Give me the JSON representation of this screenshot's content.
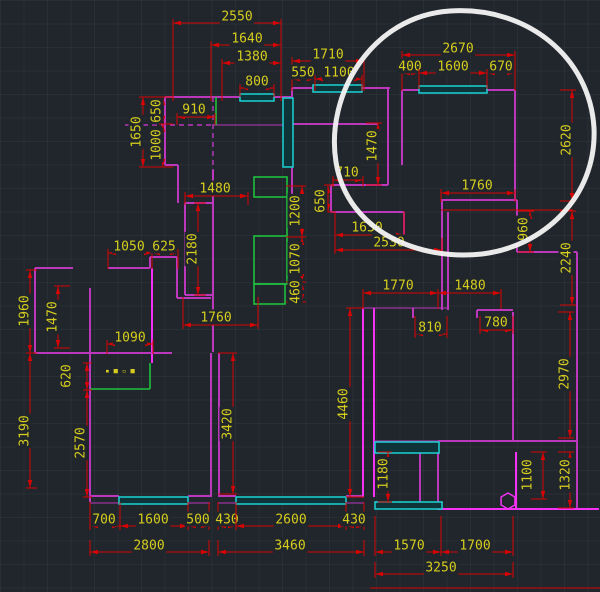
{
  "canvas": {
    "width": 600,
    "height": 592,
    "description": "CAD floor plan drawing with dimension annotations and hand-drawn circle highlight"
  },
  "colors": {
    "background": "#20262b",
    "dimension_red": "#d60404",
    "text_yellow": "#d6cd1e",
    "wall_magenta": "#bb37bb",
    "wall_bright_magenta": "#f531f5",
    "window_cyan": "#1bd3d3",
    "window_fill": "#0e3339",
    "furniture_green": "#1fbf3f",
    "annotation_white": "#f2f2f2"
  },
  "drawing": {
    "dimensions": [
      {
        "t": "2550",
        "o": "h",
        "x": 237,
        "y": 16,
        "p": 23,
        "a": 173,
        "b": 281,
        "ed": "down",
        "el": 78
      },
      {
        "t": "1640",
        "o": "h",
        "x": 247,
        "y": 38,
        "p": 45,
        "a": 211,
        "b": 281,
        "ed": "down",
        "el": 56
      },
      {
        "t": "1380",
        "o": "h",
        "x": 252,
        "y": 56,
        "p": 63,
        "a": 222,
        "b": 281,
        "ed": "down",
        "el": 38
      },
      {
        "t": "800",
        "o": "h",
        "x": 257,
        "y": 81,
        "p": 88,
        "a": 240,
        "b": 274,
        "ed": "down",
        "el": 9
      },
      {
        "t": "1710",
        "o": "h",
        "x": 328,
        "y": 54,
        "p": 61,
        "a": 292,
        "b": 364,
        "ed": "down",
        "el": 30
      },
      {
        "t": "550",
        "o": "h",
        "x": 303,
        "y": 72,
        "p": 79,
        "a": 292,
        "b": 315,
        "ed": "down",
        "el": 12
      },
      {
        "t": "1100",
        "o": "h",
        "x": 339,
        "y": 72,
        "p": 79,
        "a": 315,
        "b": 362,
        "ed": "down",
        "el": 12
      },
      {
        "t": "2670",
        "o": "h",
        "x": 458,
        "y": 48,
        "p": 55,
        "a": 402,
        "b": 515,
        "ed": "down",
        "el": 36
      },
      {
        "t": "400",
        "o": "h",
        "x": 410,
        "y": 66,
        "p": 73,
        "a": 402,
        "b": 419,
        "ed": "down",
        "el": 16
      },
      {
        "t": "1600",
        "o": "h",
        "x": 453,
        "y": 66,
        "p": 73,
        "a": 419,
        "b": 487,
        "ed": "down",
        "el": 16
      },
      {
        "t": "670",
        "o": "h",
        "x": 501,
        "y": 66,
        "p": 73,
        "a": 487,
        "b": 515,
        "ed": "down",
        "el": 16
      },
      {
        "t": "1650",
        "o": "v",
        "x": 136,
        "y": 132,
        "p": 143,
        "a": 97,
        "b": 167,
        "ed": "right",
        "el": 24
      },
      {
        "t": "650",
        "o": "v",
        "x": 156,
        "y": 111,
        "p": 163,
        "a": 97,
        "b": 124,
        "ed": "right",
        "el": 10
      },
      {
        "t": "1000",
        "o": "v",
        "x": 156,
        "y": 145,
        "p": 163,
        "a": 124,
        "b": 167,
        "ed": "right",
        "el": 10
      },
      {
        "t": "910",
        "o": "h",
        "x": 194,
        "y": 109,
        "p": 117,
        "a": 177,
        "b": 215,
        "ed": "down",
        "el": 8
      },
      {
        "t": "1480",
        "o": "h",
        "x": 215,
        "y": 188,
        "p": 196,
        "a": 185,
        "b": 248,
        "ed": "down",
        "el": 9
      },
      {
        "t": "2180",
        "o": "v",
        "x": 192,
        "y": 249,
        "p": 198,
        "a": 203,
        "b": 295,
        "ed": "right",
        "el": 8
      },
      {
        "t": "1760",
        "o": "h",
        "x": 216,
        "y": 317,
        "p": 325,
        "a": 183,
        "b": 258,
        "ed": "up",
        "el": 28
      },
      {
        "t": "1200",
        "o": "v",
        "x": 295,
        "y": 211,
        "p": 302,
        "a": 186,
        "b": 237,
        "ed": "left",
        "el": 16
      },
      {
        "t": "1070",
        "o": "v",
        "x": 295,
        "y": 259,
        "p": 302,
        "a": 237,
        "b": 282,
        "ed": "left",
        "el": 16
      },
      {
        "t": "460",
        "o": "v",
        "x": 295,
        "y": 292,
        "p": 302,
        "a": 282,
        "b": 302,
        "ed": "left",
        "el": 16
      },
      {
        "t": "1050",
        "o": "h",
        "x": 129,
        "y": 246,
        "p": 253,
        "a": 108,
        "b": 152,
        "ed": "down",
        "el": 16
      },
      {
        "t": "625",
        "o": "h",
        "x": 164,
        "y": 246,
        "p": 253,
        "a": 152,
        "b": 178,
        "ed": "down",
        "el": 16
      },
      {
        "t": "1090",
        "o": "h",
        "x": 130,
        "y": 337,
        "p": 344,
        "a": 107,
        "b": 153,
        "ed": "down",
        "el": 10
      },
      {
        "t": "1960",
        "o": "v",
        "x": 24,
        "y": 311,
        "p": 30,
        "a": 270,
        "b": 353,
        "ed": "right",
        "el": 7
      },
      {
        "t": "1470",
        "o": "v",
        "x": 52,
        "y": 317,
        "p": 58,
        "a": 286,
        "b": 348,
        "ed": "right",
        "el": 12
      },
      {
        "t": "620",
        "o": "v",
        "x": 66,
        "y": 376,
        "p": 87,
        "a": 363,
        "b": 390,
        "ed": "right",
        "el": 5
      },
      {
        "t": "2570",
        "o": "v",
        "x": 80,
        "y": 443,
        "p": 87,
        "a": 390,
        "b": 497,
        "ed": "right",
        "el": 5
      },
      {
        "t": "3190",
        "o": "v",
        "x": 24,
        "y": 431,
        "p": 30,
        "a": 353,
        "b": 488,
        "ed": "right",
        "el": 7
      },
      {
        "t": "1470",
        "o": "v",
        "x": 372,
        "y": 146,
        "p": 378,
        "a": 123,
        "b": 185,
        "ed": "left",
        "el": 12
      },
      {
        "t": "710",
        "o": "h",
        "x": 347,
        "y": 172,
        "p": 180,
        "a": 333,
        "b": 363,
        "ed": "down",
        "el": 7
      },
      {
        "t": "650",
        "o": "v",
        "x": 320,
        "y": 201,
        "p": 328,
        "a": 185,
        "b": 212,
        "ed": "right",
        "el": 6
      },
      {
        "t": "1630",
        "o": "h",
        "x": 367,
        "y": 227,
        "p": 235,
        "a": 335,
        "b": 404,
        "ed": "up",
        "el": 24
      },
      {
        "t": "2530",
        "o": "h",
        "x": 389,
        "y": 242,
        "p": 250,
        "a": 335,
        "b": 442,
        "ed": "up",
        "el": 12
      },
      {
        "t": "1760",
        "o": "h",
        "x": 477,
        "y": 185,
        "p": 193,
        "a": 441,
        "b": 515,
        "ed": "down",
        "el": 9
      },
      {
        "t": "2620",
        "o": "v",
        "x": 566,
        "y": 140,
        "p": 572,
        "a": 90,
        "b": 201,
        "ed": "left",
        "el": 12
      },
      {
        "t": "960",
        "o": "v",
        "x": 523,
        "y": 229,
        "p": 530,
        "a": 211,
        "b": 252,
        "ed": "left",
        "el": 12
      },
      {
        "t": "2240",
        "o": "v",
        "x": 566,
        "y": 258,
        "p": 572,
        "a": 211,
        "b": 305,
        "ed": "left",
        "el": 12
      },
      {
        "t": "1770",
        "o": "h",
        "x": 398,
        "y": 285,
        "p": 293,
        "a": 363,
        "b": 438,
        "ed": "down",
        "el": 16
      },
      {
        "t": "1480",
        "o": "h",
        "x": 470,
        "y": 285,
        "p": 293,
        "a": 438,
        "b": 501,
        "ed": "down",
        "el": 16
      },
      {
        "t": "810",
        "o": "h",
        "x": 430,
        "y": 327,
        "p": 334,
        "a": 415,
        "b": 447,
        "ed": "up",
        "el": 18
      },
      {
        "t": "780",
        "o": "h",
        "x": 496,
        "y": 322,
        "p": 330,
        "a": 480,
        "b": 513,
        "ed": "up",
        "el": 14
      },
      {
        "t": "2970",
        "o": "v",
        "x": 564,
        "y": 374,
        "p": 570,
        "a": 312,
        "b": 438,
        "ed": "left",
        "el": 12
      },
      {
        "t": "4460",
        "o": "v",
        "x": 343,
        "y": 404,
        "p": 350,
        "a": 308,
        "b": 497,
        "ed": "right",
        "el": 14
      },
      {
        "t": "3420",
        "o": "v",
        "x": 227,
        "y": 424,
        "p": 233,
        "a": 353,
        "b": 494,
        "ed": "left",
        "el": 15
      },
      {
        "t": "1180",
        "o": "v",
        "x": 383,
        "y": 474,
        "p": 388,
        "a": 452,
        "b": 502,
        "ed": "left",
        "el": 10
      },
      {
        "t": "1100",
        "o": "v",
        "x": 527,
        "y": 475,
        "p": 543,
        "a": 452,
        "b": 499,
        "ed": "left",
        "el": 12
      },
      {
        "t": "1320",
        "o": "v",
        "x": 565,
        "y": 475,
        "p": 570,
        "a": 452,
        "b": 508,
        "ed": "left",
        "el": 12
      },
      {
        "t": "1570",
        "o": "h",
        "x": 409,
        "y": 545,
        "p": 552,
        "a": 375,
        "b": 441,
        "ed": "up",
        "el": 36
      },
      {
        "t": "1700",
        "o": "h",
        "x": 475,
        "y": 545,
        "p": 552,
        "a": 441,
        "b": 513,
        "ed": "up",
        "el": 36
      },
      {
        "t": "3250",
        "o": "h",
        "x": 441,
        "y": 567,
        "p": 574,
        "a": 375,
        "b": 513,
        "ed": "up",
        "el": 12
      },
      {
        "t": "700",
        "o": "h",
        "x": 104,
        "y": 519,
        "p": 526,
        "a": 90,
        "b": 120,
        "ed": "up",
        "el": 24
      },
      {
        "t": "1600",
        "o": "h",
        "x": 153,
        "y": 519,
        "p": 526,
        "a": 120,
        "b": 188,
        "ed": "up",
        "el": 24
      },
      {
        "t": "500",
        "o": "h",
        "x": 198,
        "y": 519,
        "p": 526,
        "a": 188,
        "b": 209,
        "ed": "up",
        "el": 24
      },
      {
        "t": "2800",
        "o": "h",
        "x": 149,
        "y": 545,
        "p": 552,
        "a": 90,
        "b": 209,
        "ed": "up",
        "el": 12
      },
      {
        "t": "430",
        "o": "h",
        "x": 227,
        "y": 519,
        "p": 526,
        "a": 218,
        "b": 236,
        "ed": "up",
        "el": 24
      },
      {
        "t": "2600",
        "o": "h",
        "x": 291,
        "y": 519,
        "p": 526,
        "a": 236,
        "b": 346,
        "ed": "up",
        "el": 24
      },
      {
        "t": "430",
        "o": "h",
        "x": 354,
        "y": 519,
        "p": 526,
        "a": 346,
        "b": 364,
        "ed": "up",
        "el": 24
      },
      {
        "t": "3460",
        "o": "h",
        "x": 290,
        "y": 545,
        "p": 552,
        "a": 218,
        "b": 364,
        "ed": "up",
        "el": 12
      }
    ],
    "walls": [
      [
        165,
        97,
        292,
        97,
        "w"
      ],
      [
        165,
        97,
        165,
        165,
        "w"
      ],
      [
        165,
        165,
        178,
        165,
        "w"
      ],
      [
        178,
        165,
        178,
        203,
        "w"
      ],
      [
        125,
        125,
        213,
        125,
        "d"
      ],
      [
        213,
        125,
        290,
        125,
        "t"
      ],
      [
        292,
        88,
        292,
        212,
        "w"
      ],
      [
        292,
        88,
        390,
        88,
        "w"
      ],
      [
        388,
        88,
        388,
        185,
        "w"
      ],
      [
        292,
        124,
        378,
        124,
        "w"
      ],
      [
        331,
        185,
        388,
        185,
        "w"
      ],
      [
        331,
        185,
        331,
        212,
        "w"
      ],
      [
        331,
        212,
        404,
        212,
        "w"
      ],
      [
        404,
        212,
        404,
        250,
        "w"
      ],
      [
        402,
        90,
        515,
        90,
        "w"
      ],
      [
        402,
        90,
        402,
        165,
        "w"
      ],
      [
        515,
        90,
        515,
        200,
        "w"
      ],
      [
        441,
        200,
        517,
        200,
        "w"
      ],
      [
        442,
        200,
        442,
        310,
        "w"
      ],
      [
        448,
        212,
        448,
        310,
        "w"
      ],
      [
        517,
        200,
        517,
        252,
        "w"
      ],
      [
        517,
        252,
        577,
        252,
        "w"
      ],
      [
        577,
        252,
        577,
        509,
        "w"
      ],
      [
        441,
        210,
        573,
        210,
        "r"
      ],
      [
        370,
        588,
        600,
        588,
        "r"
      ],
      [
        185,
        203,
        213,
        203,
        "w"
      ],
      [
        185,
        203,
        185,
        295,
        "w"
      ],
      [
        185,
        295,
        213,
        295,
        "w"
      ],
      [
        213,
        97,
        213,
        170,
        "d"
      ],
      [
        213,
        170,
        213,
        352,
        "w"
      ],
      [
        211,
        353,
        211,
        497,
        "w"
      ],
      [
        219,
        353,
        219,
        497,
        "w"
      ],
      [
        35,
        268,
        73,
        268,
        "w"
      ],
      [
        108,
        268,
        150,
        268,
        "w"
      ],
      [
        150,
        257,
        150,
        268,
        "w"
      ],
      [
        150,
        257,
        177,
        257,
        "w"
      ],
      [
        177,
        257,
        177,
        298,
        "w"
      ],
      [
        177,
        298,
        211,
        298,
        "w"
      ],
      [
        35,
        268,
        35,
        353,
        "w"
      ],
      [
        90,
        288,
        90,
        353,
        "w"
      ],
      [
        35,
        353,
        90,
        353,
        "w"
      ],
      [
        152,
        268,
        152,
        363,
        "b"
      ],
      [
        90,
        353,
        172,
        353,
        "w"
      ],
      [
        90,
        353,
        90,
        502,
        "w"
      ],
      [
        90,
        496,
        119,
        496,
        "w"
      ],
      [
        188,
        496,
        210,
        496,
        "w"
      ],
      [
        90,
        503,
        210,
        503,
        "t"
      ],
      [
        218,
        496,
        236,
        496,
        "w"
      ],
      [
        346,
        496,
        364,
        496,
        "w"
      ],
      [
        218,
        503,
        364,
        503,
        "t"
      ],
      [
        363,
        308,
        363,
        497,
        "b"
      ],
      [
        374,
        308,
        374,
        497,
        "b"
      ],
      [
        363,
        308,
        447,
        308,
        "t"
      ],
      [
        413,
        308,
        413,
        318,
        "w"
      ],
      [
        477,
        310,
        513,
        310,
        "w"
      ],
      [
        477,
        310,
        477,
        318,
        "w"
      ],
      [
        513,
        312,
        513,
        441,
        "w"
      ],
      [
        438,
        441,
        577,
        441,
        "w"
      ],
      [
        438,
        441,
        438,
        509,
        "w"
      ],
      [
        374,
        441,
        440,
        441,
        "t"
      ],
      [
        374,
        453,
        440,
        453,
        "t"
      ],
      [
        420,
        453,
        420,
        502,
        "w"
      ],
      [
        374,
        502,
        443,
        502,
        "t"
      ],
      [
        437,
        509,
        599,
        509,
        "b"
      ],
      [
        516,
        452,
        516,
        509,
        "b"
      ]
    ],
    "windows": [
      [
        240,
        94,
        34,
        7
      ],
      [
        283,
        98,
        10,
        69
      ],
      [
        313,
        85,
        49,
        7
      ],
      [
        419,
        86,
        68,
        7
      ],
      [
        375,
        442,
        64,
        11
      ],
      [
        375,
        502,
        67,
        7
      ],
      [
        119,
        497,
        69,
        7
      ],
      [
        236,
        497,
        110,
        7
      ]
    ],
    "furniture_rects": [
      [
        254,
        177,
        33,
        20
      ],
      [
        254,
        236,
        33,
        48
      ],
      [
        254,
        284,
        31,
        20
      ]
    ],
    "furniture_lines": [
      [
        287,
        197,
        287,
        236
      ],
      [
        150,
        363,
        150,
        389
      ],
      [
        90,
        389,
        150,
        389
      ],
      [
        216,
        97,
        216,
        125
      ]
    ],
    "column_hexagon": {
      "cx": 508,
      "cy": 501,
      "r": 8
    },
    "tiny_label": {
      "x": 120,
      "y": 373,
      "text": "▪ ■ ▫ ■"
    },
    "annotation_circle": {
      "path": "M 450 11 C 528 6 590 58 594 128 C 597 198 542 247 482 254 C 420 261 347 232 336 162 C 325 94 372 16 450 11",
      "stroke_width": 5
    }
  }
}
